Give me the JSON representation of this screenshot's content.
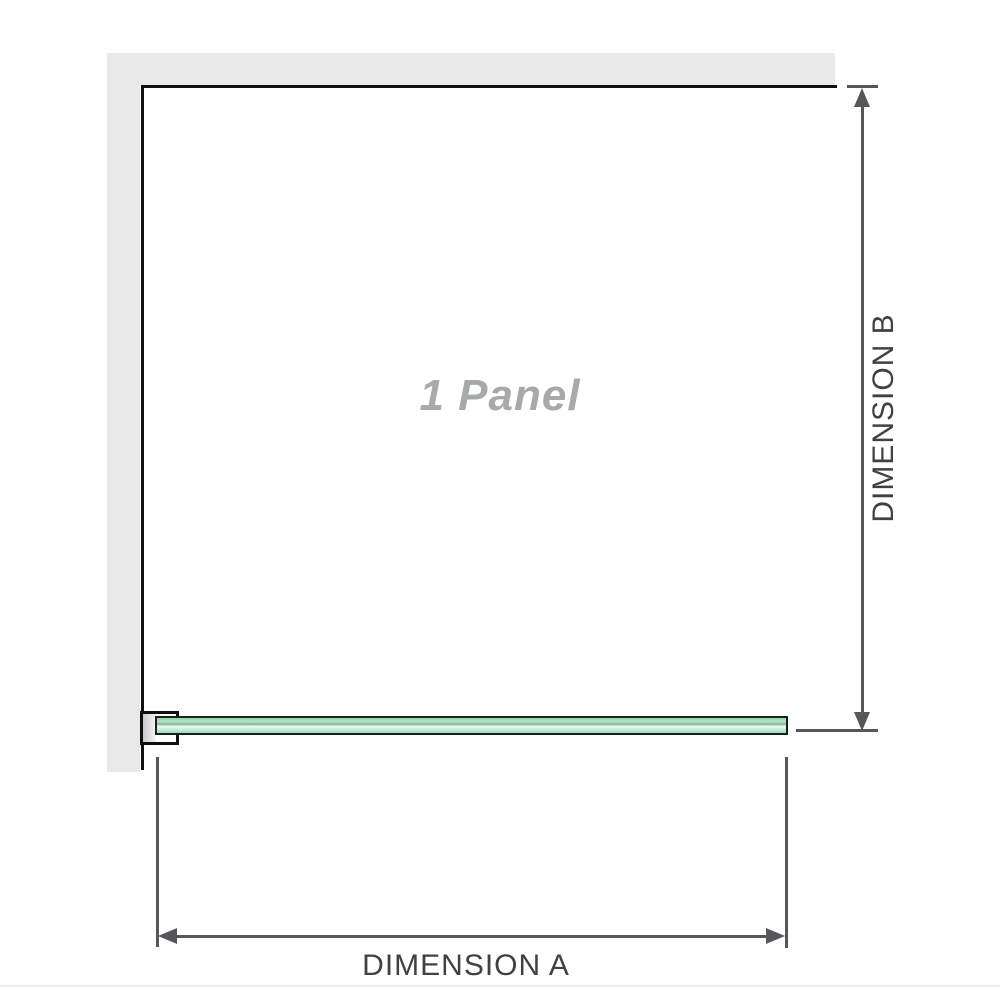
{
  "diagram": {
    "panel_label": "1 Panel",
    "dimension_a_label": "DIMENSION A",
    "dimension_b_label": "DIMENSION B",
    "colors": {
      "wall_fill": "#e9e9e9",
      "panel_outline": "#101010",
      "glass_border": "#15241b",
      "glass_fill_light": "#eefaf3",
      "glass_fill_mid": "#a3d8b9",
      "dimension_line": "#55575a",
      "dimension_text": "#3f4144",
      "panel_label_text": "#a7a9ab",
      "baseline": "#efece7"
    }
  }
}
